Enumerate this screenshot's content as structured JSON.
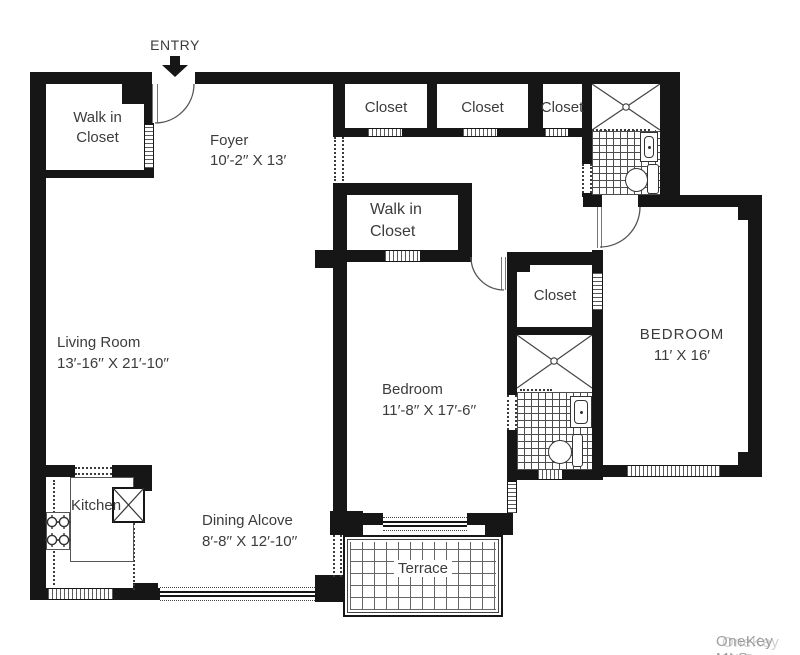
{
  "entry": {
    "label": "ENTRY"
  },
  "rooms": {
    "walkin_tl": {
      "line1": "Walk in",
      "line2": "Closet"
    },
    "foyer": {
      "name": "Foyer",
      "dims": "10′-2′′ X 13′"
    },
    "closet_a": {
      "name": "Closet"
    },
    "closet_b": {
      "name": "Closet"
    },
    "closet_c": {
      "name": "Closet"
    },
    "walkin_center": {
      "line1": "Walk in",
      "line2": "Closet"
    },
    "closet_right": {
      "name": "Closet"
    },
    "bedroom_right": {
      "name": "BEDROOM",
      "dims": "11′ X 16′"
    },
    "bedroom_middle": {
      "name": "Bedroom",
      "dims": "11′-8′′ X 17′-6′′"
    },
    "living_room": {
      "name": "Living Room",
      "dims": "13′-16′′ X 21′-10′′"
    },
    "kitchen": {
      "name": "Kitchen"
    },
    "dining_alcove": {
      "name": "Dining Alcove",
      "dims": "8′-8′′ X 12′-10′′"
    },
    "terrace": {
      "name": "Terrace"
    }
  },
  "watermark": {
    "text": "OneKey MLS"
  },
  "colors": {
    "wall": "#161616",
    "text": "#3c3c3c",
    "fixture": "#333333",
    "watermark": "#9a9a9a"
  }
}
